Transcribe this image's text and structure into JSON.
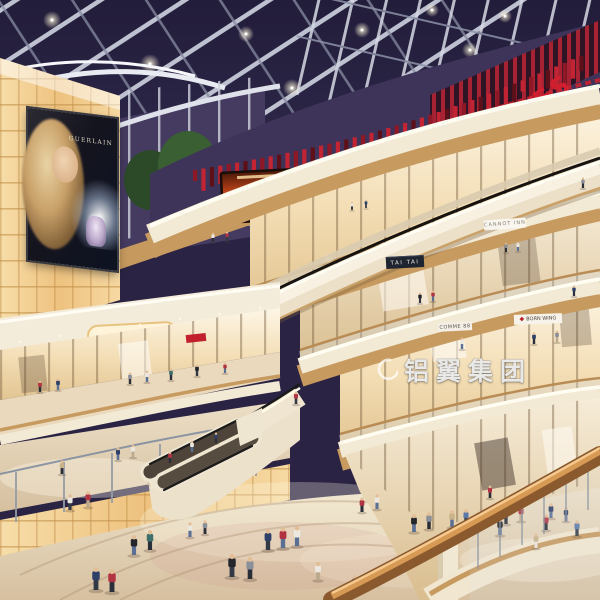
{
  "signs": {
    "theatres": "THEATRES",
    "tai_tai": "TAI TAI",
    "cannot_inn": "CANNOT INN",
    "comme_88": "COMME 88",
    "born_wing": "BORN WING"
  },
  "billboard": {
    "brand": "GUERLAIN"
  },
  "watermark": {
    "logo_text": "铝翼集团"
  },
  "colors": {
    "skylight": "#2a2343",
    "accent_red": "#c2202c",
    "fascia_cream": "#f3ead6",
    "wood": "#c79a5f",
    "amber_panel": "#f2cf93",
    "floor": "#e6d7bd"
  },
  "figures": [
    [
      213,
      242,
      9,
      "#ece8df",
      "#2a2e38"
    ],
    [
      227,
      241,
      9,
      "#b23442",
      "#333a45"
    ],
    [
      352,
      210,
      8,
      "#ece8df",
      "#2a2e38"
    ],
    [
      366,
      208,
      8,
      "#2e3f68",
      "#333a45"
    ],
    [
      583,
      188,
      10,
      "#8a8f98",
      "#2a2e38"
    ],
    [
      506,
      252,
      9,
      "#8a8f98",
      "#2a2e38"
    ],
    [
      518,
      251,
      9,
      "#ece8df",
      "#5a6f94"
    ],
    [
      420,
      303,
      10,
      "#23262b",
      "#333a45"
    ],
    [
      433,
      301,
      10,
      "#b23442",
      "#5a6f94"
    ],
    [
      574,
      296,
      10,
      "#2e3f68",
      "#2a2e38"
    ],
    [
      462,
      349,
      11,
      "#ece8df",
      "#5a6f94"
    ],
    [
      534,
      344,
      11,
      "#2e3f68",
      "#2a2e38"
    ],
    [
      557,
      342,
      11,
      "#8a8f98",
      "#baa98c"
    ],
    [
      40,
      392,
      11,
      "#b23442",
      "#2a2e38"
    ],
    [
      58,
      390,
      11,
      "#2e3f68",
      "#5a6f94"
    ],
    [
      130,
      384,
      11,
      "#8a8f98",
      "#2a2e38"
    ],
    [
      147,
      382,
      11,
      "#ece8df",
      "#5a6f94"
    ],
    [
      171,
      380,
      11,
      "#3e6f6b",
      "#2a2e38"
    ],
    [
      197,
      376,
      11,
      "#23262b",
      "#333a45"
    ],
    [
      225,
      373,
      10,
      "#b23442",
      "#5a6f94"
    ],
    [
      70,
      510,
      15,
      "#ece8df",
      "#333a45"
    ],
    [
      88,
      507,
      15,
      "#b23442",
      "#baa98c"
    ],
    [
      62,
      474,
      13,
      "#c7b289",
      "#2a2e38"
    ],
    [
      118,
      460,
      12,
      "#2e3f68",
      "#5a6f94"
    ],
    [
      133,
      457,
      12,
      "#ece8df",
      "#baa98c"
    ],
    [
      170,
      463,
      11,
      "#b23442",
      "#2a2e38"
    ],
    [
      192,
      452,
      11,
      "#ece8df",
      "#5a6f94"
    ],
    [
      216,
      443,
      10,
      "#2e3f68",
      "#2a2e38"
    ],
    [
      296,
      404,
      12,
      "#b23442",
      "#333a45"
    ],
    [
      268,
      550,
      20,
      "#2e3f68",
      "#333a45"
    ],
    [
      283,
      548,
      20,
      "#b23442",
      "#5a6f94"
    ],
    [
      297,
      546,
      19,
      "#ece8df",
      "#5a6f94"
    ],
    [
      232,
      577,
      22,
      "#23262b",
      "#333a45"
    ],
    [
      250,
      579,
      21,
      "#8a8f98",
      "#2a2e38"
    ],
    [
      318,
      580,
      17,
      "#ece8df",
      "#baa98c"
    ],
    [
      362,
      512,
      14,
      "#b23442",
      "#2a2e38"
    ],
    [
      377,
      509,
      14,
      "#ece8df",
      "#5a6f94"
    ],
    [
      414,
      532,
      17,
      "#23262b",
      "#5a6f94"
    ],
    [
      429,
      529,
      16,
      "#8a8f98",
      "#2a2e38"
    ],
    [
      452,
      527,
      16,
      "#c7b289",
      "#5a6f94"
    ],
    [
      466,
      525,
      15,
      "#5b79a8",
      "#2a2e38"
    ],
    [
      506,
      524,
      15,
      "#6b3fa0",
      "#2a2e38"
    ],
    [
      521,
      521,
      15,
      "#b23442",
      "#baa98c"
    ],
    [
      551,
      518,
      14,
      "#2e3f68",
      "#5a6f94"
    ],
    [
      150,
      550,
      19,
      "#3e6f6b",
      "#2a2e38"
    ],
    [
      134,
      555,
      19,
      "#23262b",
      "#5a6f94"
    ],
    [
      96,
      590,
      22,
      "#2e3f68",
      "#333a45"
    ],
    [
      112,
      592,
      22,
      "#b23442",
      "#2a2e38"
    ],
    [
      190,
      537,
      14,
      "#ece8df",
      "#5a6f94"
    ],
    [
      205,
      534,
      13,
      "#8a8f98",
      "#2a2e38"
    ],
    [
      355,
      592,
      16,
      "#5b79a8",
      "#2a2e38"
    ],
    [
      500,
      535,
      16,
      "#23262b",
      "#5a6f94"
    ],
    [
      546,
      530,
      15,
      "#b23442",
      "#2a2e38"
    ],
    [
      577,
      536,
      15,
      "#5b79a8",
      "#333a45"
    ],
    [
      490,
      498,
      12,
      "#b23442",
      "#2a2e38"
    ],
    [
      566,
      521,
      13,
      "#2e3f68",
      "#5a6f94"
    ],
    [
      536,
      548,
      14,
      "#c7b289",
      "#e8e4da"
    ]
  ]
}
